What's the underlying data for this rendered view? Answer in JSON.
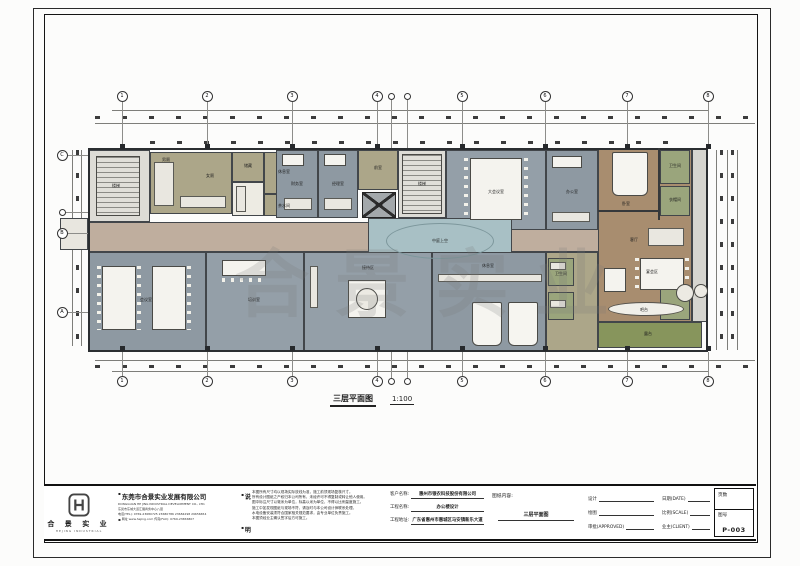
{
  "sheet": {
    "watermark": "合景实业",
    "caption": {
      "title": "三层平面图",
      "scale": "1:100"
    }
  },
  "titleblock": {
    "logo": {
      "name": "合 景 实 业",
      "sub": "HEJING INDUSTRIAL"
    },
    "company": {
      "name": "东莞市合景实业发展有限公司",
      "name_en": "DONGGUAN HE JING INDUSTRIAL DEVELOPMENT CO., LTD.",
      "address": "东莞市东城大道汇展商务中心八层",
      "tel": "电话(TEL): 0769-23680725  23680786  23684298  29656654",
      "web": "网址 www.hejing.com        传真(FAX): 0769-23656807"
    },
    "notes": {
      "label_top": "说",
      "label_bottom": "明",
      "lines": [
        "本图所有尺寸均以现场实际放线为准，施工前须现场复核尺寸。",
        "所有设计图纸之产权归本公司所有，未经许可不得复制或转让他人使用。",
        "图中标注尺寸以毫米为单位，标高以米为单位，不得以比例量度施工。",
        "施工中如发现图纸与现场不符，请及时与本公司设计师联系处理。",
        "水电设备安装须符合国家相关规范要求，由专业单位负责施工。",
        "本图须经业主确认签字后方可施工。"
      ]
    },
    "project": {
      "client_label": "客户名称:",
      "client": "惠州市银农科技股份有限公司",
      "name_label": "工程名称:",
      "name": "办公楼设计",
      "addr_label": "工程地址:",
      "addr": "广东省惠州市惠城区马安镇新乐大道",
      "content_label": "图纸内容:",
      "content": "三层平面图"
    },
    "sign": {
      "design": "设计",
      "draw": "绘图",
      "approve": "审批(APPROVED)",
      "date": "日期(DATE)",
      "scale": "比例(SCALE)",
      "client": "业主(CLIENT)"
    },
    "number": {
      "pages_label": "页数",
      "no_label": "图号",
      "no": "P-003"
    }
  },
  "colors": {
    "room_blue_gray": "#8e99a2",
    "room_blue_gray_light": "#949fa8",
    "room_khaki": "#aca689",
    "room_green": "#9aa57c",
    "corridor_tan": "#bfae9e",
    "suite_brown": "#a88d6f",
    "atrium_blue": "#a8c0c5",
    "terrace_green": "#87955c",
    "stair_gray": "#dddcd6",
    "wall": "#35383b"
  },
  "plan": {
    "rooms": [
      {
        "n": "corridor",
        "x": 88,
        "y": 222,
        "w": 512,
        "h": 30,
        "c": "#bfae9e"
      },
      {
        "n": "stairwell-west",
        "x": 88,
        "y": 150,
        "w": 62,
        "h": 72,
        "c": "#dddcd6"
      },
      {
        "n": "washroom-block",
        "x": 150,
        "y": 152,
        "w": 82,
        "h": 62,
        "c": "#aca689"
      },
      {
        "n": "store",
        "x": 232,
        "y": 152,
        "w": 32,
        "h": 30,
        "c": "#aca689"
      },
      {
        "n": "pantry",
        "x": 232,
        "y": 182,
        "w": 32,
        "h": 34,
        "c": "#edebe3"
      },
      {
        "n": "lounge-small",
        "x": 264,
        "y": 152,
        "w": 40,
        "h": 42,
        "c": "#aca689"
      },
      {
        "n": "tea-room",
        "x": 264,
        "y": 194,
        "w": 40,
        "h": 22,
        "c": "#aca689"
      },
      {
        "n": "office-1",
        "x": 276,
        "y": 150,
        "w": 42,
        "h": 68,
        "c": "#8e99a2"
      },
      {
        "n": "office-2",
        "x": 318,
        "y": 150,
        "w": 40,
        "h": 68,
        "c": "#8e99a2"
      },
      {
        "n": "lift-lobby",
        "x": 358,
        "y": 150,
        "w": 40,
        "h": 40,
        "c": "#aca689"
      },
      {
        "n": "stair-core",
        "x": 398,
        "y": 150,
        "w": 48,
        "h": 68,
        "c": "#dddcd6"
      },
      {
        "n": "conference-large",
        "x": 446,
        "y": 150,
        "w": 100,
        "h": 80,
        "c": "#949fa8"
      },
      {
        "n": "office-3",
        "x": 546,
        "y": 150,
        "w": 52,
        "h": 80,
        "c": "#8e99a2"
      },
      {
        "n": "executive-suite",
        "x": 598,
        "y": 148,
        "w": 94,
        "h": 174,
        "c": "#a88d6f"
      },
      {
        "n": "bathroom-1",
        "x": 660,
        "y": 150,
        "w": 30,
        "h": 34,
        "c": "#9aa57c"
      },
      {
        "n": "bathroom-2",
        "x": 660,
        "y": 186,
        "w": 30,
        "h": 30,
        "c": "#9aa57c"
      },
      {
        "n": "service-right",
        "x": 692,
        "y": 148,
        "w": 16,
        "h": 174,
        "c": "#d6d5cf"
      },
      {
        "n": "atrium-void",
        "x": 368,
        "y": 218,
        "w": 144,
        "h": 46,
        "c": "#a8c0c5"
      },
      {
        "n": "meeting-room",
        "x": 88,
        "y": 252,
        "w": 118,
        "h": 100,
        "c": "#8e99a2"
      },
      {
        "n": "training-room",
        "x": 206,
        "y": 252,
        "w": 98,
        "h": 100,
        "c": "#949fa8"
      },
      {
        "n": "reception-area",
        "x": 304,
        "y": 252,
        "w": 128,
        "h": 100,
        "c": "#949fa8"
      },
      {
        "n": "rest-lounge",
        "x": 432,
        "y": 252,
        "w": 114,
        "h": 100,
        "c": "#8e99a2"
      },
      {
        "n": "service-mid",
        "x": 546,
        "y": 252,
        "w": 52,
        "h": 100,
        "c": "#aca689"
      },
      {
        "n": "wash-1",
        "x": 548,
        "y": 258,
        "w": 26,
        "h": 28,
        "c": "#9aa57c"
      },
      {
        "n": "wash-2",
        "x": 548,
        "y": 292,
        "w": 26,
        "h": 28,
        "c": "#9aa57c"
      },
      {
        "n": "green-room",
        "x": 660,
        "y": 288,
        "w": 30,
        "h": 32,
        "c": "#9aa57c"
      },
      {
        "n": "terrace",
        "x": 598,
        "y": 322,
        "w": 104,
        "h": 26,
        "c": "#87955c"
      },
      {
        "n": "balcony-west",
        "x": 60,
        "y": 218,
        "w": 28,
        "h": 32,
        "c": "#e8e6df"
      }
    ],
    "walls": [
      {
        "x": 658,
        "y": 148,
        "w": 2,
        "h": 72
      },
      {
        "x": 598,
        "y": 210,
        "w": 60,
        "h": 2
      }
    ],
    "furniture": [
      {
        "x": 96,
        "y": 156,
        "w": 44,
        "h": 60,
        "t": "stairs-h"
      },
      {
        "x": 154,
        "y": 162,
        "w": 20,
        "h": 44,
        "t": "counter"
      },
      {
        "x": 180,
        "y": 196,
        "w": 46,
        "h": 12,
        "t": "counter"
      },
      {
        "x": 236,
        "y": 186,
        "w": 10,
        "h": 26,
        "t": "counter"
      },
      {
        "x": 282,
        "y": 154,
        "w": 22,
        "h": 12,
        "t": "table"
      },
      {
        "x": 284,
        "y": 198,
        "w": 28,
        "h": 12,
        "t": "counter"
      },
      {
        "x": 324,
        "y": 154,
        "w": 22,
        "h": 12,
        "t": "table"
      },
      {
        "x": 324,
        "y": 198,
        "w": 28,
        "h": 12,
        "t": "counter"
      },
      {
        "x": 362,
        "y": 192,
        "w": 34,
        "h": 26,
        "t": "elevator"
      },
      {
        "x": 402,
        "y": 154,
        "w": 40,
        "h": 60,
        "t": "stairs-h"
      },
      {
        "x": 470,
        "y": 158,
        "w": 52,
        "h": 62,
        "t": "table"
      },
      {
        "x": 464,
        "y": 158,
        "w": 4,
        "h": 62,
        "t": "dots-v"
      },
      {
        "x": 524,
        "y": 158,
        "w": 4,
        "h": 62,
        "t": "dots-v"
      },
      {
        "x": 552,
        "y": 156,
        "w": 30,
        "h": 12,
        "t": "table"
      },
      {
        "x": 552,
        "y": 212,
        "w": 38,
        "h": 10,
        "t": "counter"
      },
      {
        "x": 612,
        "y": 152,
        "w": 36,
        "h": 44,
        "t": "bed"
      },
      {
        "x": 648,
        "y": 228,
        "w": 36,
        "h": 18,
        "t": "counter"
      },
      {
        "x": 640,
        "y": 258,
        "w": 44,
        "h": 32,
        "t": "table"
      },
      {
        "x": 635,
        "y": 258,
        "w": 4,
        "h": 32,
        "t": "dots-v"
      },
      {
        "x": 685,
        "y": 258,
        "w": 4,
        "h": 32,
        "t": "dots-v"
      },
      {
        "x": 604,
        "y": 268,
        "w": 22,
        "h": 24,
        "t": "table"
      },
      {
        "x": 608,
        "y": 302,
        "w": 76,
        "h": 14,
        "t": "oval"
      },
      {
        "x": 676,
        "y": 284,
        "w": 18,
        "h": 18,
        "t": "circle"
      },
      {
        "x": 386,
        "y": 223,
        "w": 108,
        "h": 36,
        "t": "ring"
      },
      {
        "x": 102,
        "y": 266,
        "w": 34,
        "h": 64,
        "t": "table"
      },
      {
        "x": 97,
        "y": 266,
        "w": 4,
        "h": 64,
        "t": "dots-v"
      },
      {
        "x": 137,
        "y": 266,
        "w": 4,
        "h": 64,
        "t": "dots-v"
      },
      {
        "x": 152,
        "y": 266,
        "w": 34,
        "h": 64,
        "t": "table"
      },
      {
        "x": 187,
        "y": 266,
        "w": 4,
        "h": 64,
        "t": "dots-v"
      },
      {
        "x": 222,
        "y": 260,
        "w": 44,
        "h": 16,
        "t": "table"
      },
      {
        "x": 222,
        "y": 278,
        "w": 44,
        "h": 4,
        "t": "dots"
      },
      {
        "x": 310,
        "y": 266,
        "w": 8,
        "h": 42,
        "t": "counter"
      },
      {
        "x": 348,
        "y": 280,
        "w": 38,
        "h": 38,
        "t": "table"
      },
      {
        "x": 356,
        "y": 288,
        "w": 22,
        "h": 22,
        "t": "circle"
      },
      {
        "x": 438,
        "y": 274,
        "w": 104,
        "h": 8,
        "t": "counter"
      },
      {
        "x": 472,
        "y": 302,
        "w": 30,
        "h": 44,
        "t": "bed"
      },
      {
        "x": 508,
        "y": 302,
        "w": 30,
        "h": 44,
        "t": "bed"
      },
      {
        "x": 550,
        "y": 262,
        "w": 16,
        "h": 8,
        "t": "counter"
      },
      {
        "x": 550,
        "y": 300,
        "w": 16,
        "h": 8,
        "t": "counter"
      },
      {
        "x": 694,
        "y": 284,
        "w": 14,
        "h": 14,
        "t": "circle"
      }
    ],
    "labels": [
      {
        "t": "楼梯",
        "x": 116,
        "y": 186
      },
      {
        "t": "男厕",
        "x": 166,
        "y": 160
      },
      {
        "t": "女厕",
        "x": 210,
        "y": 176
      },
      {
        "t": "储藏",
        "x": 248,
        "y": 166
      },
      {
        "t": "休息室",
        "x": 284,
        "y": 172
      },
      {
        "t": "茶水间",
        "x": 284,
        "y": 206
      },
      {
        "t": "财务室",
        "x": 297,
        "y": 184
      },
      {
        "t": "经理室",
        "x": 338,
        "y": 184
      },
      {
        "t": "前室",
        "x": 378,
        "y": 168
      },
      {
        "t": "电梯",
        "x": 379,
        "y": 205
      },
      {
        "t": "楼梯",
        "x": 422,
        "y": 184
      },
      {
        "t": "大会议室",
        "x": 496,
        "y": 192
      },
      {
        "t": "办公室",
        "x": 572,
        "y": 192
      },
      {
        "t": "卧室",
        "x": 626,
        "y": 204
      },
      {
        "t": "卫生间",
        "x": 675,
        "y": 166
      },
      {
        "t": "衣帽间",
        "x": 675,
        "y": 200
      },
      {
        "t": "中庭上空",
        "x": 440,
        "y": 241
      },
      {
        "t": "会议室",
        "x": 146,
        "y": 300
      },
      {
        "t": "培训室",
        "x": 254,
        "y": 300
      },
      {
        "t": "接待区",
        "x": 368,
        "y": 268
      },
      {
        "t": "休息室",
        "x": 488,
        "y": 266
      },
      {
        "t": "卫生间",
        "x": 561,
        "y": 274
      },
      {
        "t": "客厅",
        "x": 634,
        "y": 240
      },
      {
        "t": "宴会区",
        "x": 652,
        "y": 272
      },
      {
        "t": "吧台",
        "x": 644,
        "y": 310
      },
      {
        "t": "露台",
        "x": 648,
        "y": 334
      }
    ],
    "axes": [
      {
        "type": "top",
        "y": 96,
        "to": 148,
        "items": [
          {
            "n": "1",
            "x": 122
          },
          {
            "n": "2",
            "x": 207
          },
          {
            "n": "3",
            "x": 292
          },
          {
            "n": "4",
            "x": 377
          },
          {
            "n": "",
            "x": 391,
            "s": true
          },
          {
            "n": "",
            "x": 407,
            "s": true
          },
          {
            "n": "5",
            "x": 462
          },
          {
            "n": "6",
            "x": 545
          },
          {
            "n": "7",
            "x": 627
          },
          {
            "n": "8",
            "x": 708
          }
        ]
      },
      {
        "type": "bottom",
        "y": 381,
        "to": 352,
        "items": [
          {
            "n": "1",
            "x": 122
          },
          {
            "n": "2",
            "x": 207
          },
          {
            "n": "3",
            "x": 292
          },
          {
            "n": "4",
            "x": 377
          },
          {
            "n": "",
            "x": 391,
            "s": true
          },
          {
            "n": "",
            "x": 407,
            "s": true
          },
          {
            "n": "5",
            "x": 462
          },
          {
            "n": "6",
            "x": 545
          },
          {
            "n": "7",
            "x": 627
          },
          {
            "n": "8",
            "x": 708
          }
        ]
      },
      {
        "type": "left",
        "x": 62,
        "to": 88,
        "items": [
          {
            "n": "C",
            "y": 155
          },
          {
            "n": "",
            "y": 212,
            "s": true
          },
          {
            "n": "B",
            "y": 233
          },
          {
            "n": "A",
            "y": 312
          }
        ]
      }
    ]
  }
}
